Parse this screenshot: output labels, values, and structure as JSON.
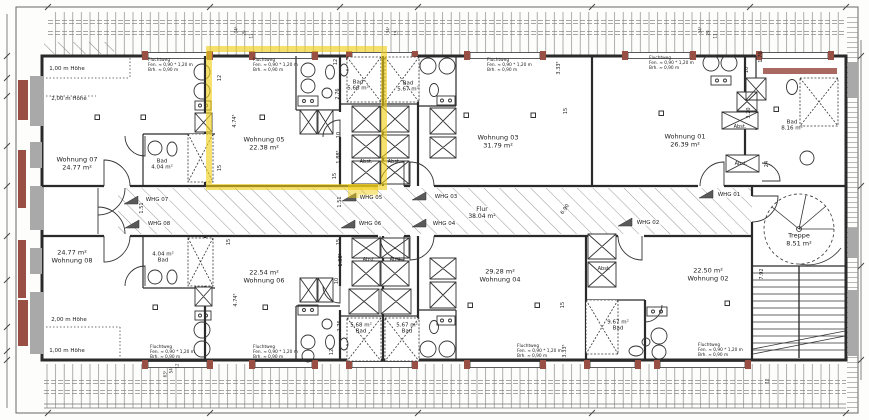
{
  "plan": {
    "highlight_color": "#f1ce17",
    "corridor": {
      "name": "Flur",
      "area": "38.04 m²"
    },
    "stairs": {
      "name": "Treppe",
      "area": "8.51 m²"
    },
    "apartments": [
      {
        "name": "Wohnung 07",
        "area": "24.77 m²"
      },
      {
        "name": "Wohnung 05",
        "area": "22.38 m²"
      },
      {
        "name": "Wohnung 03",
        "area": "31.79 m²"
      },
      {
        "name": "Wohnung 01",
        "area": "26.39 m²"
      },
      {
        "name": "Wohnung 08",
        "area": "24.77 m²"
      },
      {
        "name": "Wohnung 06",
        "area": "22.54 m²"
      },
      {
        "name": "Wohnung 04",
        "area": "29.28 m²"
      },
      {
        "name": "Wohnung 02",
        "area": "22.50 m²"
      }
    ],
    "baths": [
      {
        "name": "Bad",
        "area": "4.04 m²"
      },
      {
        "name": "Bad",
        "area": "5.66 m²"
      },
      {
        "name": "Bad",
        "area": "5.67 m²"
      },
      {
        "name": "Bad",
        "area": "8.16 m²"
      },
      {
        "name": "Bad",
        "area": "4.04 m²"
      },
      {
        "name": "Bad",
        "area": "5.68 m²"
      },
      {
        "name": "Bad",
        "area": "5.67 m²"
      },
      {
        "name": "Bad",
        "area": "9.67 m²"
      }
    ],
    "entries": [
      "WHG 07",
      "WHG 08",
      "WHG 05",
      "WHG 06",
      "WHG 03",
      "WHG 04",
      "WHG 01",
      "WHG 02"
    ],
    "storage_label": "Abst.",
    "height_notes": {
      "one_m": "1,00 m Höhe",
      "two_m": "2,00 m Höhe"
    },
    "escape_route": {
      "line1": "Fluchtweg",
      "line2": "Fen. ≈ 0,90 * 1,20 m",
      "line3": "Brh. ≈ 0,90 m"
    },
    "dims": {
      "d12": "12",
      "d15": "15",
      "d10": "10",
      "d24": "24",
      "d11": "11",
      "d29": "29",
      "d474": "4.74⁵",
      "d276": "2.76",
      "d188": "1.88⁵",
      "d151": "1.51",
      "d690": "6.90",
      "d333": "3.33⁵",
      "d176": "1.76",
      "d320": "3.20",
      "d792": "7.92",
      "d345": "34⁵",
      "d635": "63⁵",
      "d545": "54⁵"
    }
  }
}
